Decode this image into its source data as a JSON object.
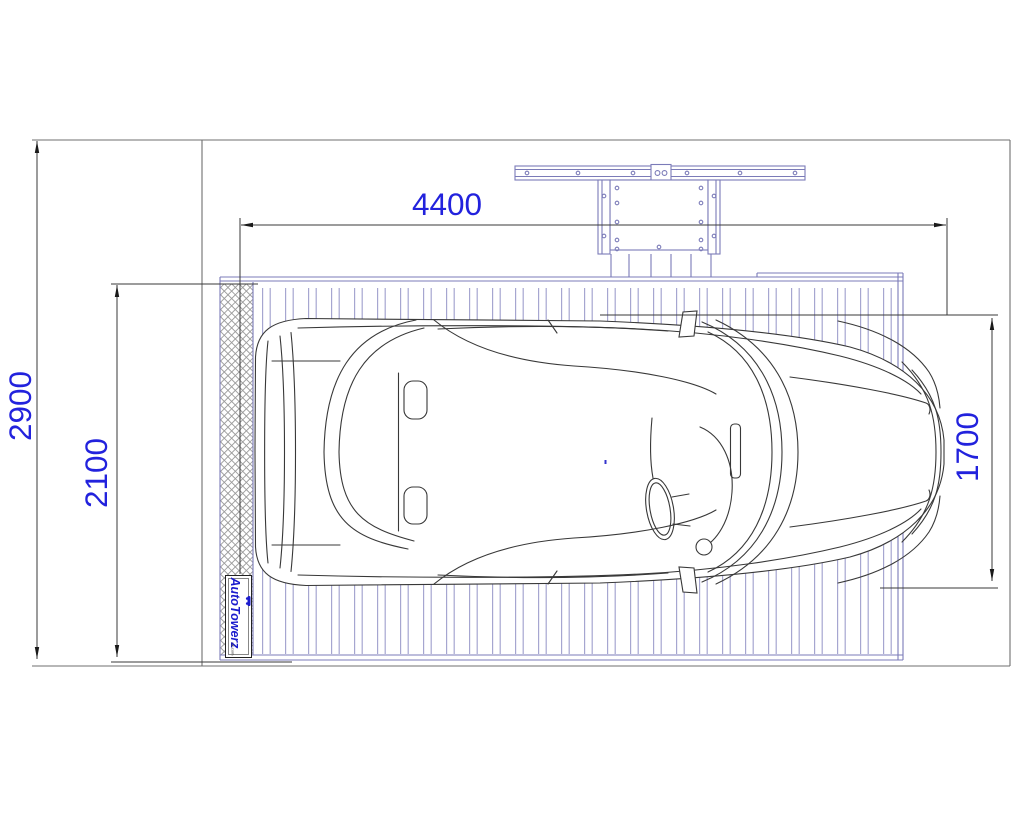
{
  "drawing": {
    "title": "car-lift-platform-plan-view",
    "dimensions": {
      "total_length": {
        "value": "4400",
        "orientation": "horizontal",
        "measures": "platform length"
      },
      "overall_depth": {
        "value": "2900",
        "orientation": "vertical",
        "measures": "overall garage depth"
      },
      "platform_width": {
        "value": "2100",
        "orientation": "vertical",
        "measures": "platform width"
      },
      "car_width": {
        "value": "1700",
        "orientation": "vertical",
        "measures": "car width"
      }
    },
    "logo": {
      "brand": "AutoTowerz",
      "small_print": "uk.com"
    },
    "colors": {
      "dimension_text": "#2222dd",
      "dimension_line": "#3a3a3a",
      "garage_outline": "#6f6f6f",
      "structure_blue": "#7b7bb8",
      "slat_blue": "#a6a6d0",
      "hatch_gray": "#9a9a9a",
      "car_line": "#383838",
      "logo_blue": "#1b1bcd",
      "background": "#ffffff"
    }
  }
}
